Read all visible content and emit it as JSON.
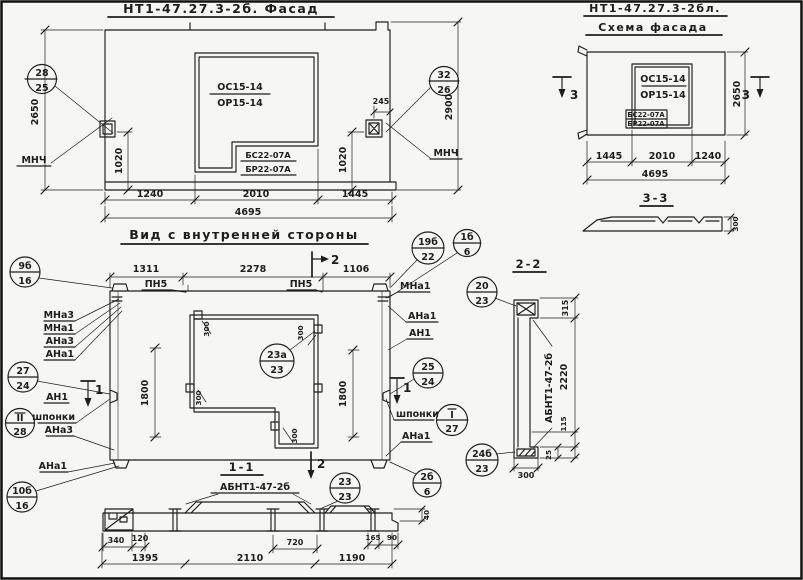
{
  "colors": {
    "ink": "#1d1d1b",
    "paper": "#f6f6f3"
  },
  "facade": {
    "title": "НТ1-47.27.3-2б. Фасад",
    "window_mark_top": "ОС15-14",
    "window_mark_bottom": "ОР15-14",
    "sill_mark_top": "БС22-07А",
    "sill_mark_bottom": "БР22-07А",
    "callout_left": {
      "top": "28",
      "bottom": "25"
    },
    "callout_right": {
      "top": "32",
      "bottom": "26"
    },
    "anchor_label_left": "МНЧ",
    "anchor_label_right": "МНЧ",
    "dim_height_left": "2650",
    "dim_height_right": "2900",
    "dim_anchor_left": "1020",
    "dim_anchor_right": "1020",
    "dim_anchor_edge": "245",
    "dims_bottom": [
      "1240",
      "2010",
      "1445"
    ],
    "dim_total": "4695"
  },
  "schema": {
    "title_line1": "НТ1-47.27.3-2бл.",
    "title_line2": "Схема фасада",
    "window_mark_top": "ОС15-14",
    "window_mark_bottom": "ОР15-14",
    "sill_mark_top": "БС22-07А",
    "sill_mark_bottom": "БР22-07А",
    "dims_bottom": [
      "1445",
      "2010",
      "1240"
    ],
    "dim_total": "4695",
    "dim_height": "2650",
    "section_label": "3"
  },
  "section_3_3": {
    "title": "3-3",
    "dim_thickness": "300"
  },
  "inner_view": {
    "title": "Вид с внутренней стороны",
    "dims_top": [
      "1311",
      "2278",
      "1106"
    ],
    "rail_label": "ПН5",
    "dim_side": "1800",
    "dim_tab": "300",
    "section_label_1": "1",
    "section_label_2": "2",
    "labels_left": [
      "МНа3",
      "МНа1",
      "АНа3",
      "АНа1"
    ],
    "label_an1_left": "АН1",
    "label_keys": "шпонки",
    "label_ana3_lower": "АНа3",
    "label_ana1_lower": "АНа1",
    "labels_right": [
      "МНа1",
      "АНа1",
      "АН1"
    ],
    "label_keys_right": "шпонки",
    "label_ana1_right": "АНа1",
    "callouts": {
      "c19b_22": {
        "top": "19б",
        "bottom": "22"
      },
      "c1b_6": {
        "top": "1б",
        "bottom": "6"
      },
      "c9b_16": {
        "top": "9б",
        "bottom": "16"
      },
      "c27_24": {
        "top": "27",
        "bottom": "24"
      },
      "cII_28": {
        "top": "II",
        "bottom": "28"
      },
      "c10b_16": {
        "top": "10б",
        "bottom": "16"
      },
      "c25_24": {
        "top": "25",
        "bottom": "24"
      },
      "cI_27": {
        "top": "I",
        "bottom": "27"
      },
      "c23a_23": {
        "top": "23а",
        "bottom": "23"
      },
      "c23_23": {
        "top": "23",
        "bottom": "23"
      },
      "c2b_6": {
        "top": "2б",
        "bottom": "6"
      }
    }
  },
  "section_1_1": {
    "title": "1-1",
    "subtitle": "АБНТ1-47-2б",
    "dim_340": "340",
    "dim_120": "120",
    "dim_720": "720",
    "dim_165": "165",
    "dim_90": "90",
    "dim_40": "40",
    "dims_bottom": [
      "1395",
      "2110",
      "1190"
    ]
  },
  "section_2_2": {
    "title": "2-2",
    "member_label": "АБНТ1-47-2б",
    "callout_top": {
      "top": "20",
      "bottom": "23"
    },
    "callout_bottom": {
      "top": "24б",
      "bottom": "23"
    },
    "dim_315": "315",
    "dim_2220": "2220",
    "dim_115": "115",
    "dim_25": "25",
    "dim_width": "300"
  }
}
